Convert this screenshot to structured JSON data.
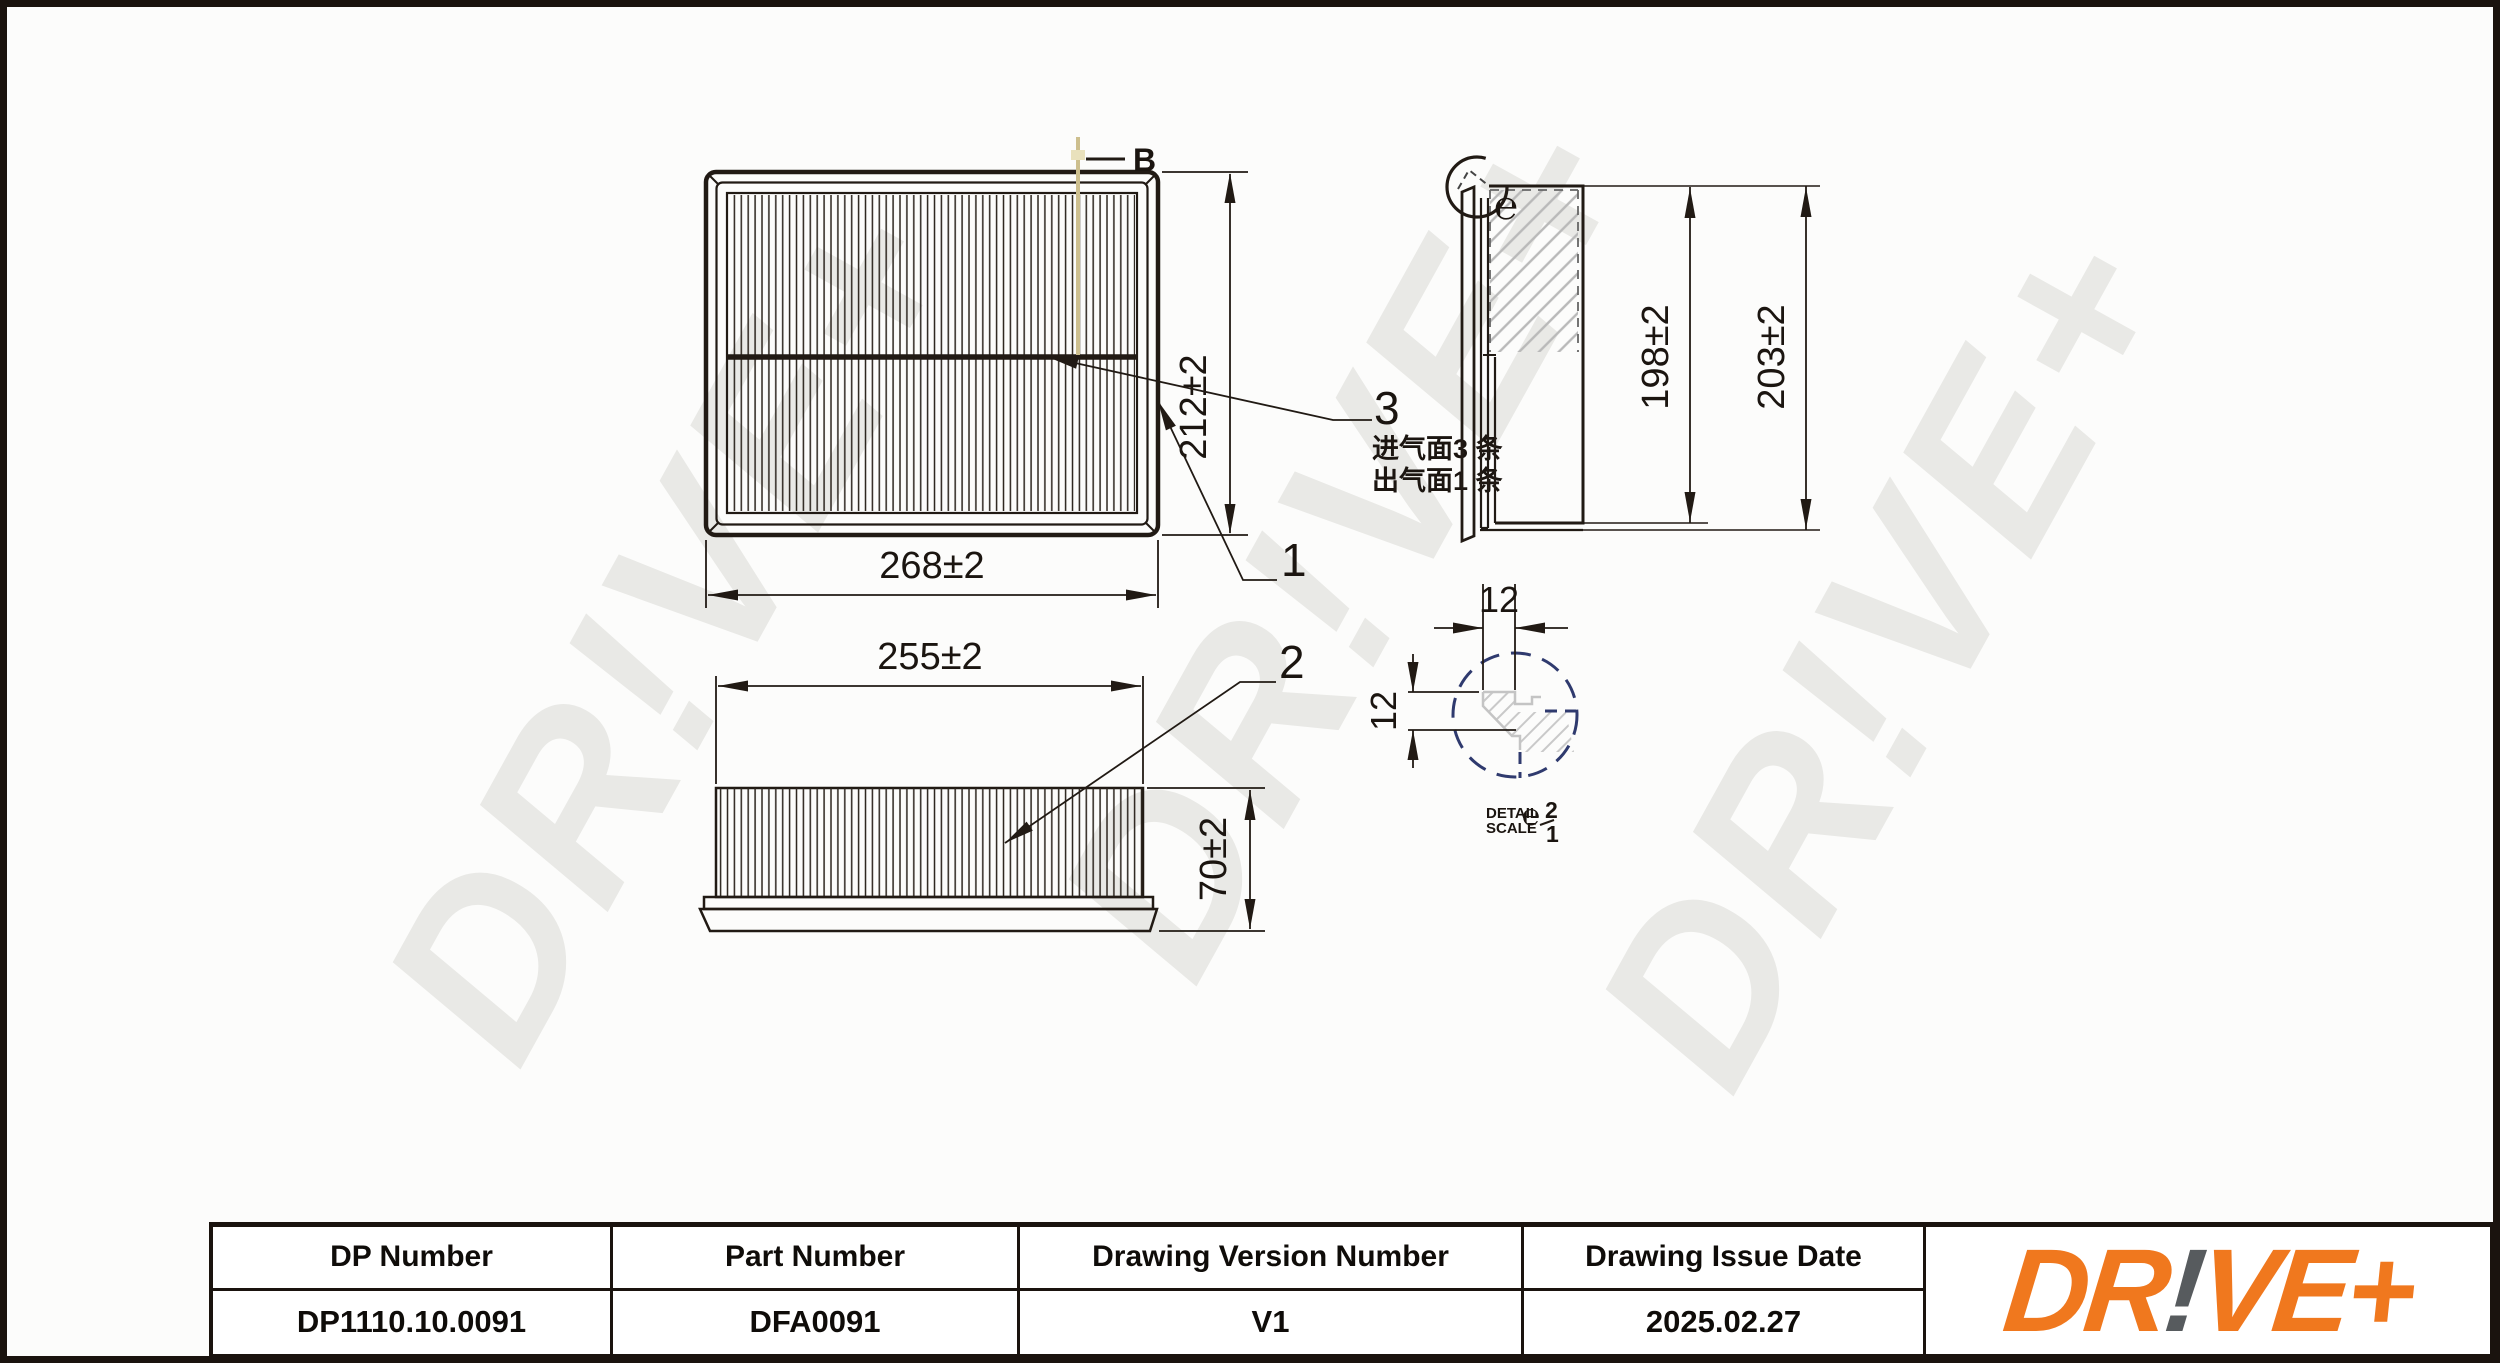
{
  "watermark": {
    "text": "DR!VE+"
  },
  "views": {
    "top": {
      "width": "268±2",
      "height": "212±2",
      "section_label": "B"
    },
    "side": {
      "width": "255±2",
      "height": "70±2"
    },
    "profile": {
      "inner_height": "198±2",
      "outer_height": "203±2",
      "detail_marker": "℮"
    },
    "detail": {
      "width": "12",
      "height": "12",
      "note_line1": "DETAIL",
      "note_line2": "SCALE",
      "marker": "℮",
      "scale_num": "2",
      "scale_den": "1"
    }
  },
  "callouts": {
    "frame": "1",
    "media": "2",
    "seam": "3"
  },
  "notes": {
    "intake": "进气面3 条",
    "outlet": "出气面1 条"
  },
  "table": {
    "headers": [
      "DP Number",
      "Part Number",
      "Drawing Version Number",
      "Drawing Issue Date"
    ],
    "values": [
      "DP1110.10.0091",
      "DFA0091",
      "V1",
      "2025.02.27"
    ]
  },
  "logo": {
    "part1": "DR",
    "part2": "!",
    "part3": "VE+"
  },
  "colors": {
    "accent_orange": "#F0781E",
    "logo_gray": "#575B5E",
    "detail_navy": "#2F3A6E",
    "section_line_tan": "#CDBF8E",
    "watermark_gray": "#E9E9E6"
  }
}
